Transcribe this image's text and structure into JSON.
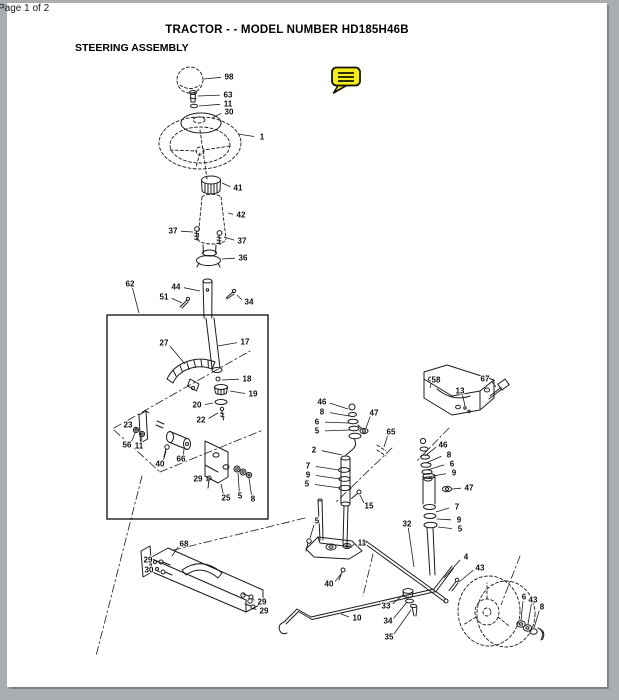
{
  "page_chrome": {
    "page_label": "Page 1 of 2",
    "background_color": "#aaaeb1",
    "page_color": "#ffffff"
  },
  "header": {
    "title": "TRACTOR - - MODEL NUMBER HD185H46B",
    "section": "STEERING ASSEMBLY"
  },
  "annotation": {
    "type": "sticky-note-comment",
    "color": "#f4ec1c",
    "border_color": "#141400"
  },
  "diagram": {
    "description": "Exploded parts diagram of steering assembly",
    "callouts": [
      {
        "n": "98",
        "x": 229,
        "y": 77,
        "tx": 204,
        "ty": 79
      },
      {
        "n": "63",
        "x": 228,
        "y": 95,
        "tx": 198,
        "ty": 96
      },
      {
        "n": "11",
        "x": 228,
        "y": 104,
        "tx": 199,
        "ty": 106
      },
      {
        "n": "30",
        "x": 229,
        "y": 112,
        "tx": 212,
        "ty": 118
      },
      {
        "n": "1",
        "x": 262,
        "y": 137,
        "tx": 238,
        "ty": 134
      },
      {
        "n": "41",
        "x": 238,
        "y": 188,
        "tx": 222,
        "ty": 183
      },
      {
        "n": "42",
        "x": 241,
        "y": 215,
        "tx": 228,
        "ty": 213
      },
      {
        "n": "37",
        "x": 173,
        "y": 231,
        "tx": 193,
        "ty": 232
      },
      {
        "n": "37",
        "x": 242,
        "y": 241,
        "tx": 224,
        "ty": 237
      },
      {
        "n": "36",
        "x": 243,
        "y": 258,
        "tx": 222,
        "ty": 259
      },
      {
        "n": "62",
        "x": 130,
        "y": 284,
        "tx": 139,
        "ty": 313
      },
      {
        "n": "44",
        "x": 176,
        "y": 287,
        "tx": 200,
        "ty": 291
      },
      {
        "n": "51",
        "x": 164,
        "y": 297,
        "tx": 182,
        "ty": 303
      },
      {
        "n": "34",
        "x": 249,
        "y": 302,
        "tx": 237,
        "ty": 295
      },
      {
        "n": "27",
        "x": 164,
        "y": 343,
        "tx": 185,
        "ty": 364
      },
      {
        "n": "17",
        "x": 245,
        "y": 342,
        "tx": 218,
        "ty": 346
      },
      {
        "n": "18",
        "x": 247,
        "y": 379,
        "tx": 222,
        "ty": 380
      },
      {
        "n": "19",
        "x": 253,
        "y": 394,
        "tx": 230,
        "ty": 391
      },
      {
        "n": "20",
        "x": 197,
        "y": 405,
        "tx": 213,
        "ty": 403
      },
      {
        "n": "22",
        "x": 201,
        "y": 420,
        "tx": 218,
        "ty": 413
      },
      {
        "n": "23",
        "x": 128,
        "y": 425,
        "tx": 137,
        "ty": 430
      },
      {
        "n": "56",
        "x": 127,
        "y": 445,
        "tx": 135,
        "ty": 433
      },
      {
        "n": "11",
        "x": 139,
        "y": 446,
        "tx": 142,
        "ty": 437
      },
      {
        "n": "40",
        "x": 160,
        "y": 464,
        "tx": 166,
        "ty": 451
      },
      {
        "n": "66",
        "x": 181,
        "y": 459,
        "tx": 184,
        "ty": 449
      },
      {
        "n": "29",
        "x": 198,
        "y": 479,
        "tx": 208,
        "ty": 481
      },
      {
        "n": "25",
        "x": 226,
        "y": 498,
        "tx": 221,
        "ty": 484
      },
      {
        "n": "5",
        "x": 240,
        "y": 496,
        "tx": 238,
        "ty": 473
      },
      {
        "n": "8",
        "x": 253,
        "y": 499,
        "tx": 249,
        "ty": 478
      },
      {
        "n": "46",
        "x": 322,
        "y": 402,
        "tx": 348,
        "ty": 409
      },
      {
        "n": "8",
        "x": 322,
        "y": 412,
        "tx": 349,
        "ty": 416
      },
      {
        "n": "6",
        "x": 317,
        "y": 422,
        "tx": 349,
        "ty": 423
      },
      {
        "n": "5",
        "x": 317,
        "y": 431,
        "tx": 350,
        "ty": 430
      },
      {
        "n": "2",
        "x": 314,
        "y": 450,
        "tx": 342,
        "ty": 455
      },
      {
        "n": "7",
        "x": 308,
        "y": 466,
        "tx": 339,
        "ty": 470
      },
      {
        "n": "9",
        "x": 308,
        "y": 475,
        "tx": 340,
        "ty": 479
      },
      {
        "n": "5",
        "x": 307,
        "y": 484,
        "tx": 340,
        "ty": 488
      },
      {
        "n": "47",
        "x": 374,
        "y": 413,
        "tx": 366,
        "ty": 428
      },
      {
        "n": "65",
        "x": 391,
        "y": 432,
        "tx": 384,
        "ty": 447
      },
      {
        "n": "15",
        "x": 369,
        "y": 506,
        "tx": 360,
        "ty": 495
      },
      {
        "n": "32",
        "x": 407,
        "y": 524,
        "tx": 414,
        "ty": 567
      },
      {
        "n": "58",
        "x": 436,
        "y": 380,
        "tx": 430,
        "ty": 388
      },
      {
        "n": "13",
        "x": 460,
        "y": 391,
        "tx": 465,
        "ty": 406
      },
      {
        "n": "67",
        "x": 485,
        "y": 379,
        "tx": 496,
        "ty": 387
      },
      {
        "n": "46",
        "x": 443,
        "y": 445,
        "tx": 425,
        "ty": 456
      },
      {
        "n": "8",
        "x": 449,
        "y": 455,
        "tx": 426,
        "ty": 463
      },
      {
        "n": "6",
        "x": 452,
        "y": 464,
        "tx": 427,
        "ty": 470
      },
      {
        "n": "9",
        "x": 454,
        "y": 473,
        "tx": 428,
        "ty": 477
      },
      {
        "n": "47",
        "x": 469,
        "y": 488,
        "tx": 452,
        "ty": 489
      },
      {
        "n": "7",
        "x": 457,
        "y": 507,
        "tx": 436,
        "ty": 512
      },
      {
        "n": "9",
        "x": 459,
        "y": 520,
        "tx": 437,
        "ty": 519
      },
      {
        "n": "5",
        "x": 460,
        "y": 529,
        "tx": 438,
        "ty": 527
      },
      {
        "n": "4",
        "x": 466,
        "y": 557,
        "tx": 444,
        "ty": 578
      },
      {
        "n": "43",
        "x": 480,
        "y": 568,
        "tx": 459,
        "ty": 582
      },
      {
        "n": "6",
        "x": 524,
        "y": 597,
        "tx": 521,
        "ty": 620
      },
      {
        "n": "43",
        "x": 533,
        "y": 600,
        "tx": 528,
        "ty": 624
      },
      {
        "n": "8",
        "x": 542,
        "y": 607,
        "tx": 534,
        "ty": 628
      },
      {
        "n": "68",
        "x": 184,
        "y": 544,
        "tx": 172,
        "ty": 556
      },
      {
        "n": "29",
        "x": 148,
        "y": 560,
        "tx": 158,
        "ty": 562
      },
      {
        "n": "30",
        "x": 149,
        "y": 570,
        "tx": 160,
        "ty": 572
      },
      {
        "n": "29",
        "x": 262,
        "y": 602,
        "tx": 252,
        "ty": 598
      },
      {
        "n": "29",
        "x": 264,
        "y": 611,
        "tx": 254,
        "ty": 608
      },
      {
        "n": "5",
        "x": 317,
        "y": 521,
        "tx": 310,
        "ty": 538
      },
      {
        "n": "11",
        "x": 362,
        "y": 543,
        "tx": 352,
        "ty": 546
      },
      {
        "n": "40",
        "x": 329,
        "y": 584,
        "tx": 341,
        "ty": 574
      },
      {
        "n": "10",
        "x": 357,
        "y": 618,
        "tx": 341,
        "ty": 614
      },
      {
        "n": "33",
        "x": 386,
        "y": 606,
        "tx": 404,
        "ty": 594
      },
      {
        "n": "34",
        "x": 388,
        "y": 621,
        "tx": 407,
        "ty": 602
      },
      {
        "n": "35",
        "x": 389,
        "y": 637,
        "tx": 411,
        "ty": 610
      }
    ]
  }
}
